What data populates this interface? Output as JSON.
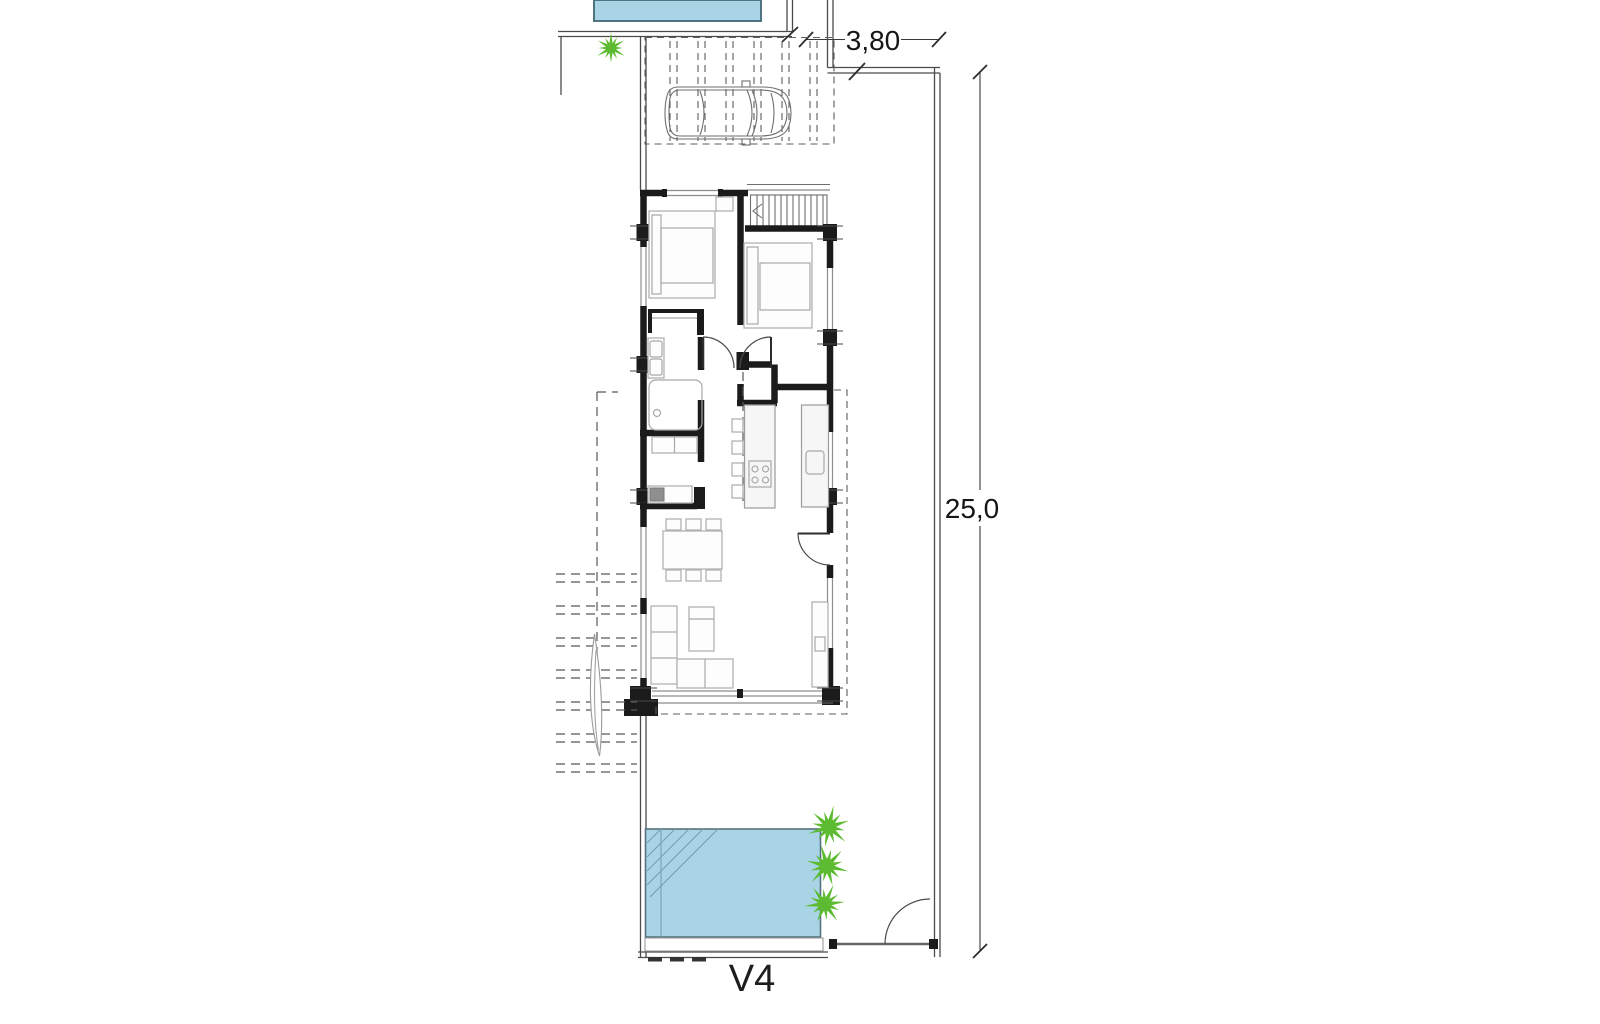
{
  "sheet": {
    "unit_label": "V4"
  },
  "dimensions": {
    "width_label": "3,80",
    "depth_label": "25,0"
  },
  "colors": {
    "pool_fill": "#a9d4e6",
    "palm_green": "#5cbb30"
  }
}
